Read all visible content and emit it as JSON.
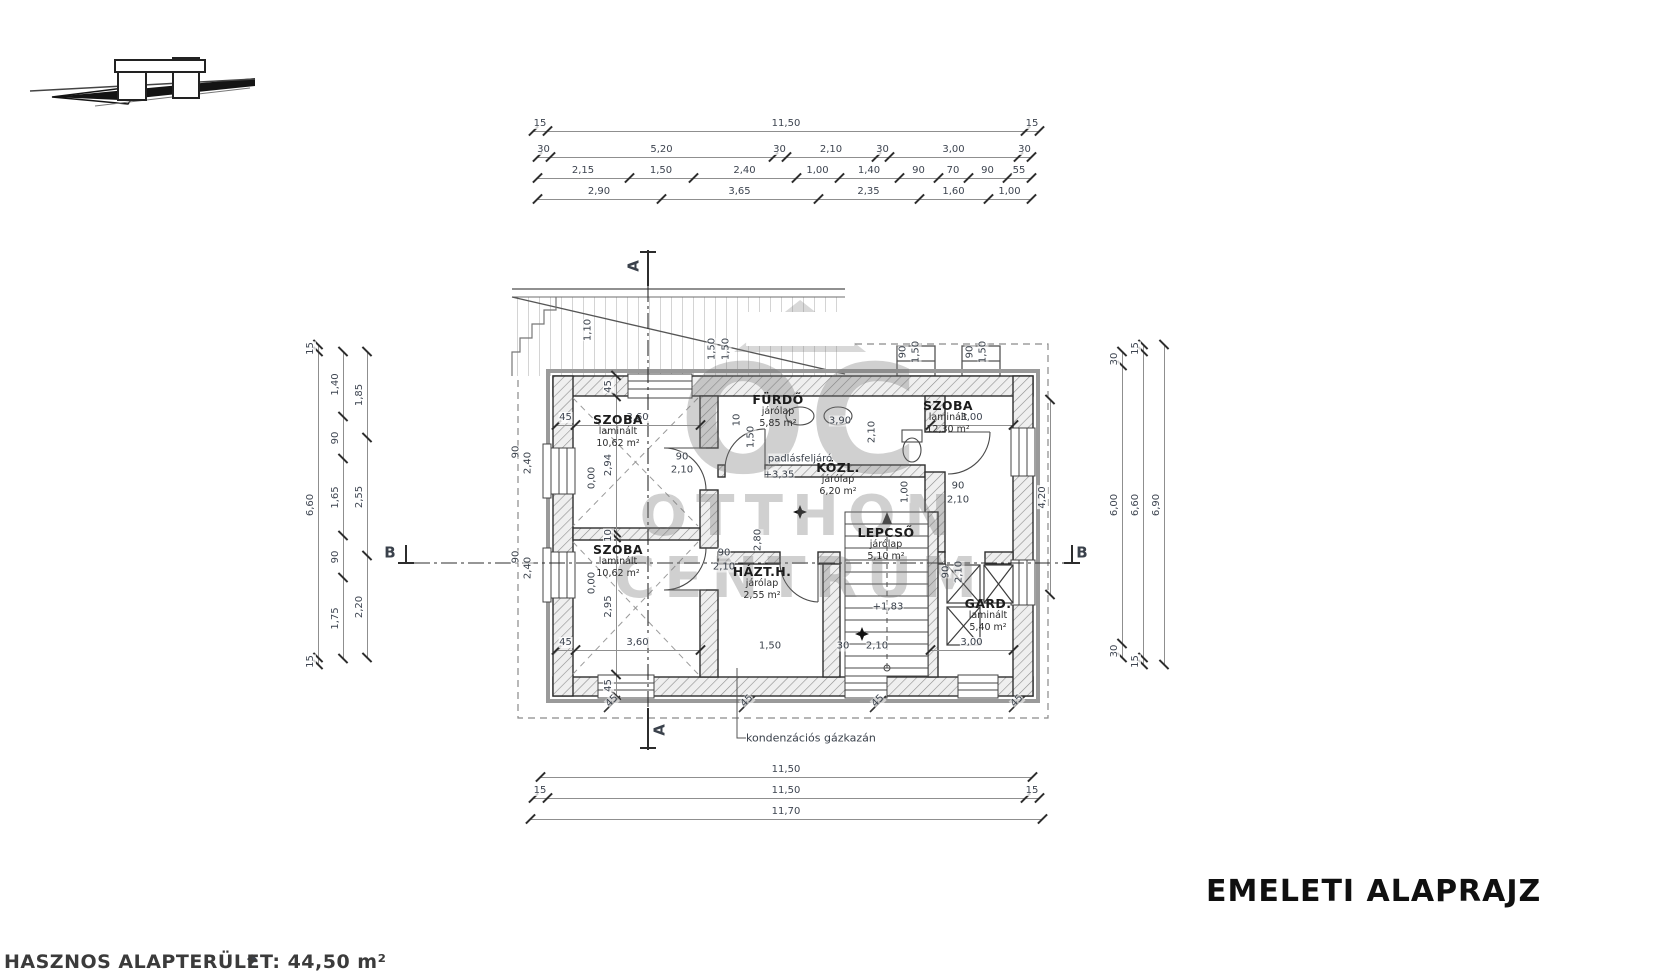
{
  "title": "EMELETI ALAPRAJZ",
  "footer": "HASZNOS ALAPTERÜLET: 44,50 m²",
  "watermark": {
    "monogram": "OC",
    "word1": "OTTHON",
    "word2": "CENTRUM"
  },
  "annotation_boiler": "kondenzációs gázkazán",
  "rooms": [
    {
      "x": 618,
      "y": 432,
      "name": "SZOBA",
      "floor": "laminált",
      "area": "10,62 m²"
    },
    {
      "x": 618,
      "y": 562,
      "name": "SZOBA",
      "floor": "laminált",
      "area": "10,62 m²"
    },
    {
      "x": 778,
      "y": 412,
      "name": "FÜRDŐ",
      "floor": "járólap",
      "area": "5,85 m²"
    },
    {
      "x": 838,
      "y": 480,
      "name": "KÖZL.",
      "floor": "járólap",
      "area": "6,20 m²"
    },
    {
      "x": 886,
      "y": 545,
      "name": "LEPCSŐ",
      "floor": "járólap",
      "area": "5,10 m²"
    },
    {
      "x": 762,
      "y": 584,
      "name": "HÁZT.H.",
      "floor": "járólap",
      "area": "2,55 m²"
    },
    {
      "x": 948,
      "y": 418,
      "name": "SZOBA",
      "floor": "laminált",
      "area": "12,30 m²"
    },
    {
      "x": 988,
      "y": 616,
      "name": "GARD.",
      "floor": "laminált",
      "area": "5,40 m²"
    }
  ],
  "dim_chains": [
    {
      "x": 533,
      "y": 131,
      "d": "h",
      "segs": [
        {
          "w": 14,
          "t": "15"
        },
        {
          "w": 478,
          "t": "11,50"
        },
        {
          "w": 14,
          "t": "15"
        }
      ]
    },
    {
      "x": 537,
      "y": 157,
      "d": "h",
      "segs": [
        {
          "w": 13,
          "t": "30"
        },
        {
          "w": 223,
          "t": "5,20"
        },
        {
          "w": 13,
          "t": "30"
        },
        {
          "w": 90,
          "t": "2,10"
        },
        {
          "w": 13,
          "t": "30"
        },
        {
          "w": 129,
          "t": "3,00"
        },
        {
          "w": 13,
          "t": "30"
        }
      ]
    },
    {
      "x": 537,
      "y": 178,
      "d": "h",
      "segs": [
        {
          "w": 92,
          "t": "2,15"
        },
        {
          "w": 64,
          "t": "1,50"
        },
        {
          "w": 103,
          "t": "2,40"
        },
        {
          "w": 43,
          "t": "1,00"
        },
        {
          "w": 60,
          "t": "1,40"
        },
        {
          "w": 39,
          "t": "90"
        },
        {
          "w": 30,
          "t": "70"
        },
        {
          "w": 39,
          "t": "90"
        },
        {
          "w": 24,
          "t": "55"
        }
      ]
    },
    {
      "x": 537,
      "y": 199,
      "d": "h",
      "segs": [
        {
          "w": 124,
          "t": "2,90"
        },
        {
          "w": 157,
          "t": "3,65"
        },
        {
          "w": 101,
          "t": "2,35"
        },
        {
          "w": 69,
          "t": "1,60"
        },
        {
          "w": 43,
          "t": "1,00"
        }
      ]
    },
    {
      "x": 318,
      "y": 345,
      "d": "v",
      "segs": [
        {
          "w": 7,
          "t": "15"
        },
        {
          "w": 306,
          "t": "6,60"
        },
        {
          "w": 7,
          "t": "15"
        }
      ]
    },
    {
      "x": 343,
      "y": 352,
      "d": "v",
      "segs": [
        {
          "w": 81,
          "t": "1,75"
        },
        {
          "w": 42,
          "t": "90"
        },
        {
          "w": 77,
          "t": "1,65"
        },
        {
          "w": 42,
          "t": "90"
        },
        {
          "w": 65,
          "t": "1,40"
        }
      ]
    },
    {
      "x": 367,
      "y": 352,
      "d": "v",
      "segs": [
        {
          "w": 102,
          "t": "2,20"
        },
        {
          "w": 118,
          "t": "2,55"
        },
        {
          "w": 86,
          "t": "1,85"
        }
      ]
    },
    {
      "x": 1122,
      "y": 352,
      "d": "v",
      "segs": [
        {
          "w": 14,
          "t": "30"
        },
        {
          "w": 278,
          "t": "6,00"
        },
        {
          "w": 14,
          "t": "30"
        }
      ]
    },
    {
      "x": 1143,
      "y": 345,
      "d": "v",
      "segs": [
        {
          "w": 7,
          "t": "15"
        },
        {
          "w": 306,
          "t": "6,60"
        },
        {
          "w": 7,
          "t": "15"
        }
      ]
    },
    {
      "x": 1164,
      "y": 345,
      "d": "v",
      "segs": [
        {
          "w": 320,
          "t": "6,90"
        }
      ]
    },
    {
      "x": 540,
      "y": 777,
      "d": "h",
      "segs": [
        {
          "w": 492,
          "t": "11,50"
        }
      ]
    },
    {
      "x": 533,
      "y": 798,
      "d": "h",
      "segs": [
        {
          "w": 14,
          "t": "15"
        },
        {
          "w": 478,
          "t": "11,50"
        },
        {
          "w": 14,
          "t": "15"
        }
      ]
    },
    {
      "x": 530,
      "y": 819,
      "d": "h",
      "segs": [
        {
          "w": 512,
          "t": "11,70"
        }
      ]
    },
    {
      "x": 616,
      "y": 376,
      "d": "v",
      "segs": [
        {
          "w": 21,
          "t": "45"
        },
        {
          "w": 137,
          "t": "2,95"
        },
        {
          "w": 5,
          "t": "10"
        },
        {
          "w": 136,
          "t": "2,94"
        },
        {
          "w": 21,
          "t": "45"
        }
      ]
    },
    {
      "x": 556,
      "y": 425,
      "d": "h",
      "segs": [
        {
          "w": 19,
          "t": "45"
        },
        {
          "w": 125,
          "t": "3,60"
        }
      ]
    },
    {
      "x": 930,
      "y": 425,
      "d": "h",
      "segs": [
        {
          "w": 83,
          "t": "3,00"
        }
      ]
    },
    {
      "x": 556,
      "y": 650,
      "d": "h",
      "segs": [
        {
          "w": 19,
          "t": "45"
        },
        {
          "w": 125,
          "t": "3,60"
        }
      ]
    },
    {
      "x": 930,
      "y": 650,
      "d": "h",
      "segs": [
        {
          "w": 83,
          "t": "3,00"
        }
      ]
    },
    {
      "x": 1050,
      "y": 400,
      "d": "v",
      "segs": [
        {
          "w": 195,
          "t": "4,20"
        }
      ]
    }
  ],
  "plan_labels": [
    {
      "t": "1,10",
      "x": 588,
      "y": 330,
      "r": -90
    },
    {
      "t": "1,50",
      "x": 712,
      "y": 349,
      "r": -90
    },
    {
      "t": "1,50",
      "x": 726,
      "y": 349,
      "r": -90
    },
    {
      "t": "90",
      "x": 903,
      "y": 352,
      "r": -90
    },
    {
      "t": "1,50",
      "x": 916,
      "y": 352,
      "r": -90
    },
    {
      "t": "90",
      "x": 970,
      "y": 352,
      "r": -90
    },
    {
      "t": "1,50",
      "x": 983,
      "y": 352,
      "r": -90
    },
    {
      "t": "90",
      "x": 516,
      "y": 452,
      "r": -90
    },
    {
      "t": "2,40",
      "x": 528,
      "y": 463,
      "r": -90
    },
    {
      "t": "90",
      "x": 516,
      "y": 557,
      "r": -90
    },
    {
      "t": "2,40",
      "x": 528,
      "y": 568,
      "r": -90
    },
    {
      "t": "0,00",
      "x": 592,
      "y": 478,
      "r": -90
    },
    {
      "t": "0,00",
      "x": 592,
      "y": 583,
      "r": -90
    },
    {
      "t": "10",
      "x": 737,
      "y": 420,
      "r": -90
    },
    {
      "t": "1,50",
      "x": 751,
      "y": 437,
      "r": -90
    },
    {
      "t": "2,10",
      "x": 872,
      "y": 432,
      "r": -90
    },
    {
      "t": "1,00",
      "x": 905,
      "y": 492,
      "r": -90
    },
    {
      "t": "2,80",
      "x": 758,
      "y": 540,
      "r": -90
    },
    {
      "t": "3,90",
      "x": 840,
      "y": 421
    },
    {
      "t": "90",
      "x": 682,
      "y": 457
    },
    {
      "t": "2,10",
      "x": 682,
      "y": 470
    },
    {
      "t": "90",
      "x": 724,
      "y": 553
    },
    {
      "t": "2,10",
      "x": 724,
      "y": 567
    },
    {
      "t": "90",
      "x": 958,
      "y": 486
    },
    {
      "t": "2,10",
      "x": 958,
      "y": 500
    },
    {
      "t": "90",
      "x": 946,
      "y": 572,
      "r": -90
    },
    {
      "t": "2,10",
      "x": 959,
      "y": 572,
      "r": -90
    },
    {
      "t": "45",
      "x": 612,
      "y": 701,
      "r": -45
    },
    {
      "t": "45",
      "x": 747,
      "y": 701,
      "r": -45
    },
    {
      "t": "45",
      "x": 878,
      "y": 701,
      "r": -45
    },
    {
      "t": "45",
      "x": 1017,
      "y": 701,
      "r": -45
    },
    {
      "t": "1,50",
      "x": 770,
      "y": 646
    },
    {
      "t": "30",
      "x": 843,
      "y": 646
    },
    {
      "t": "2,10",
      "x": 877,
      "y": 646
    },
    {
      "t": "padlásfeljáró",
      "x": 800,
      "y": 459,
      "n": "attic-access-note"
    },
    {
      "t": "+3,35",
      "x": 779,
      "y": 475,
      "n": "level-mark"
    },
    {
      "t": "+1,83",
      "x": 888,
      "y": 607,
      "n": "level-mark"
    },
    {
      "t": "kondenzációs gázkazán",
      "x": 746,
      "y": 738,
      "s": 11,
      "a": "left",
      "n": "boiler-annotation"
    },
    {
      "t": "A",
      "x": 634,
      "y": 266,
      "r": -90,
      "b": 1,
      "s": 15,
      "n": "section-mark-a-top"
    },
    {
      "t": "A",
      "x": 660,
      "y": 730,
      "r": -90,
      "b": 1,
      "s": 15,
      "n": "section-mark-a-bottom"
    },
    {
      "t": "B",
      "x": 390,
      "y": 553,
      "b": 1,
      "s": 15,
      "n": "section-mark-b-left"
    },
    {
      "t": "B",
      "x": 1082,
      "y": 553,
      "b": 1,
      "s": 15,
      "n": "section-mark-b-right"
    },
    {
      "t": "◆",
      "x": 252,
      "y": 959,
      "s": 13,
      "n": "footer-mark"
    }
  ]
}
